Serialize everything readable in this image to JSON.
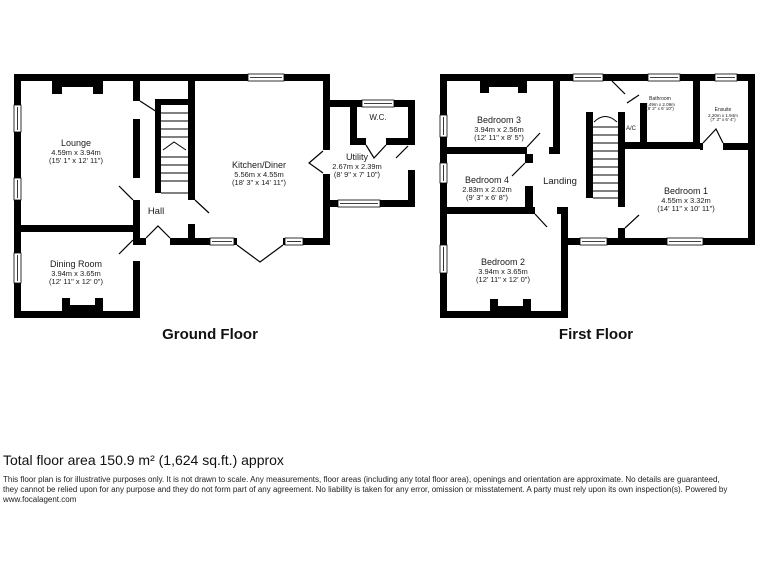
{
  "ground_floor": {
    "title": "Ground Floor",
    "rooms": {
      "lounge": {
        "name": "Lounge",
        "metric": "4.59m x 3.94m",
        "imperial": "(15' 1\" x 12' 11\")"
      },
      "dining": {
        "name": "Dining Room",
        "metric": "3.94m x 3.65m",
        "imperial": "(12' 11\" x 12' 0\")"
      },
      "hall": {
        "name": "Hall"
      },
      "kitchen": {
        "name": "Kitchen/Diner",
        "metric": "5.56m x 4.55m",
        "imperial": "(18' 3\" x 14' 11\")"
      },
      "wc": {
        "name": "W.C."
      },
      "utility": {
        "name": "Utility",
        "metric": "2.67m x 2.39m",
        "imperial": "(8' 9\" x 7' 10\")"
      }
    }
  },
  "first_floor": {
    "title": "First Floor",
    "rooms": {
      "bedroom3": {
        "name": "Bedroom 3",
        "metric": "3.94m x 2.56m",
        "imperial": "(12' 11\" x 8' 5\")"
      },
      "bedroom4": {
        "name": "Bedroom 4",
        "metric": "2.83m x 2.02m",
        "imperial": "(9' 3\" x 6' 8\")"
      },
      "bedroom2": {
        "name": "Bedroom 2",
        "metric": "3.94m x 3.65m",
        "imperial": "(12' 11\" x 12' 0\")"
      },
      "bedroom1": {
        "name": "Bedroom 1",
        "metric": "4.55m x 3.32m",
        "imperial": "(14' 11\" x 10' 11\")"
      },
      "landing": {
        "name": "Landing"
      },
      "ac": {
        "name": "A/C"
      },
      "bathroom": {
        "name": "Bathroom",
        "metric": "2.49m x 2.09m",
        "imperial": "(8' 2\" x 6' 10\")"
      },
      "ensuite": {
        "name": "Ensuite",
        "metric": "2.20m x 1.94m",
        "imperial": "(7' 3\" x 6' 4\")"
      }
    }
  },
  "footer": {
    "total_area": "Total floor area 150.9 m² (1,624 sq.ft.) approx",
    "disclaimer_lines": [
      "This floor plan is for illustrative purposes only. It is not drawn to scale. Any measurements, floor areas (including any total floor area), openings and orientation are approximate. No details are guaranteed,",
      "they cannot be relied upon for any purpose and they do not form part of any agreement. No liability is taken for any error, omission or misstatement. A party must rely upon its own inspection(s). Powered by",
      "www.focalagent.com"
    ]
  },
  "colors": {
    "wall": "#000000",
    "background": "#ffffff",
    "text": "#1a1a1a"
  }
}
